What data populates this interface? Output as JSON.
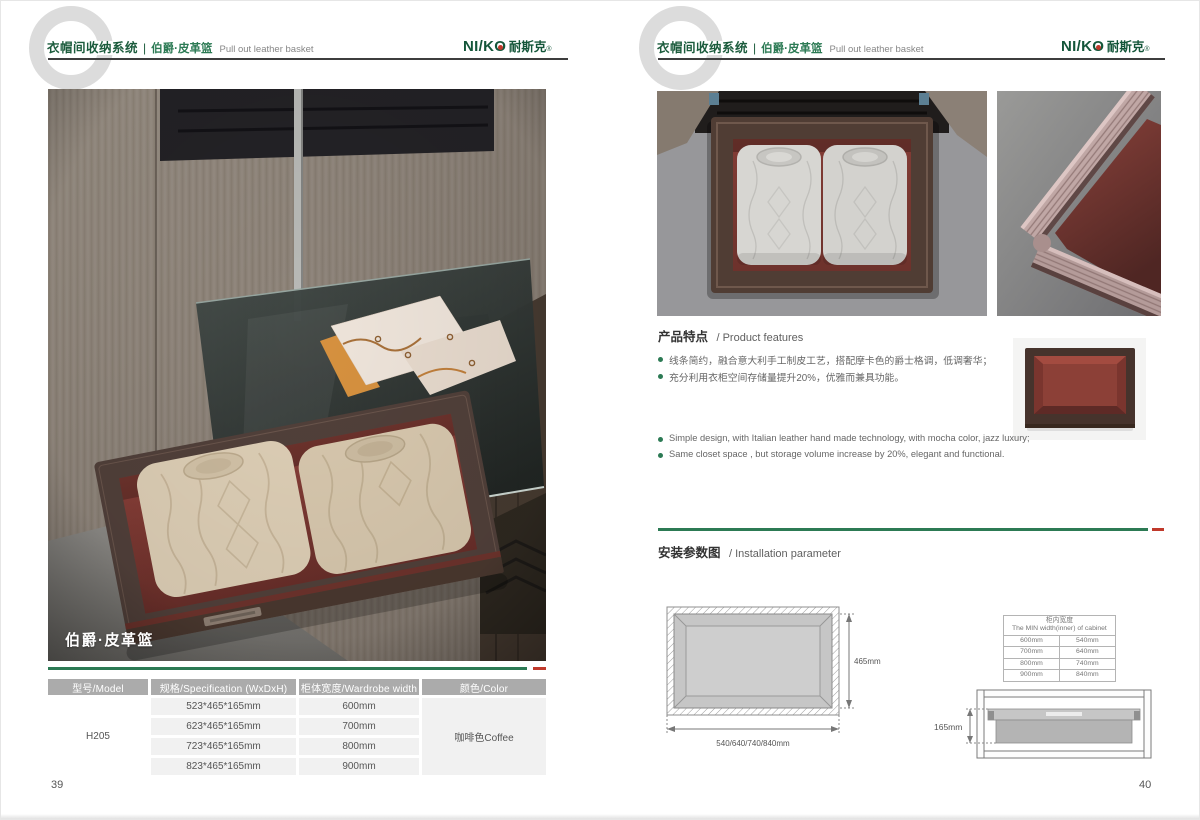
{
  "colors": {
    "green": "#2c7a54",
    "red": "#c0392b",
    "logo_green": "#14563a"
  },
  "header": {
    "watermark": "C",
    "system_cn": "衣帽间收纳系统",
    "sep": "|",
    "product_cn": "伯爵·皮革篮",
    "product_en": "Pull out leather basket"
  },
  "brand": {
    "logo_a": "NI/K",
    "logo_o": "O",
    "logo_cn": "耐斯克",
    "reg": "®"
  },
  "pages": {
    "left_number": "39",
    "right_number": "40"
  },
  "photo": {
    "caption": "伯爵·皮革篮"
  },
  "spec_table": {
    "headers": [
      "型号/Model",
      "规格/Specification (WxDxH)",
      "柜体宽度/Wardrobe width",
      "颜色/Color"
    ],
    "model": "H205",
    "rows": [
      {
        "spec": "523*465*165mm",
        "width": "600mm"
      },
      {
        "spec": "623*465*165mm",
        "width": "700mm"
      },
      {
        "spec": "723*465*165mm",
        "width": "800mm"
      },
      {
        "spec": "823*465*165mm",
        "width": "900mm"
      }
    ],
    "color": "咖啡色Coffee"
  },
  "features": {
    "title_cn": "产品特点",
    "title_en": "/ Product features",
    "cn": [
      "线条简约，融合意大利手工制皮工艺，搭配摩卡色的爵士格调，低调奢华；",
      "充分利用衣柜空间存储量提升20%，优雅而兼具功能。"
    ],
    "en": [
      "Simple design, with Italian leather hand made technology, with mocha color, jazz  luxury;",
      "Same closet space ,  but storage volume increase by 20%, elegant and functional."
    ]
  },
  "installation": {
    "title_cn": "安装参数图",
    "title_en": "/ Installation parameter",
    "top_view": {
      "depth": "465mm",
      "widths": "540/640/740/840mm"
    },
    "front_view": {
      "height": "165mm"
    },
    "min_table": {
      "title_cn": "柜内宽度",
      "title_en": "The MIN width(inner) of cabinet",
      "rows": [
        [
          "600mm",
          "540mm"
        ],
        [
          "700mm",
          "640mm"
        ],
        [
          "800mm",
          "740mm"
        ],
        [
          "900mm",
          "840mm"
        ]
      ]
    }
  }
}
